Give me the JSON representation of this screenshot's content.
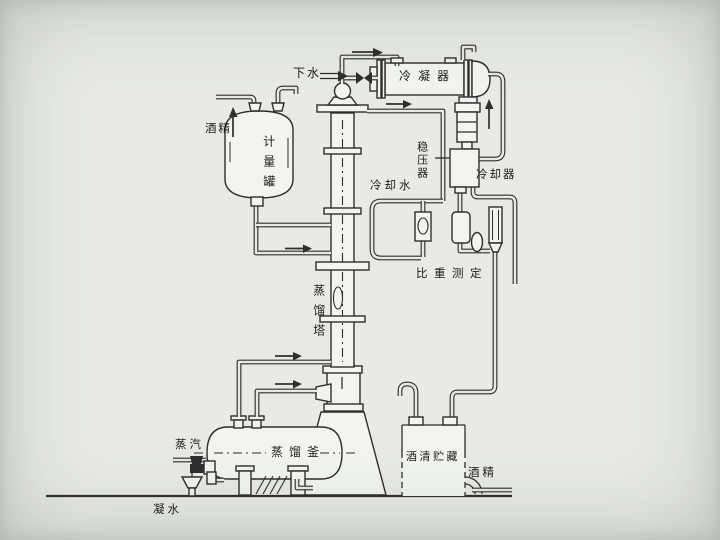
{
  "colors": {
    "paper": "#e8ebe5",
    "line": "#2e2e2e",
    "vessel": "#f1f4ef"
  },
  "labels": {
    "drain_water": "下水",
    "condenser": "冷凝器",
    "alcohol_feed": "酒精",
    "measuring_tank": "计量罐",
    "pressure_stabilizer": "稳压器",
    "cooling_water": "冷却水",
    "cooler": "冷却器",
    "gravity_measurement": "比重测定",
    "distillation_column": "蒸馏塔",
    "distillation_kettle": "蒸馏釜",
    "steam": "蒸汽",
    "alcohol_storage": "酒清贮藏",
    "alcohol_out": "酒精",
    "condensate": "凝水"
  }
}
